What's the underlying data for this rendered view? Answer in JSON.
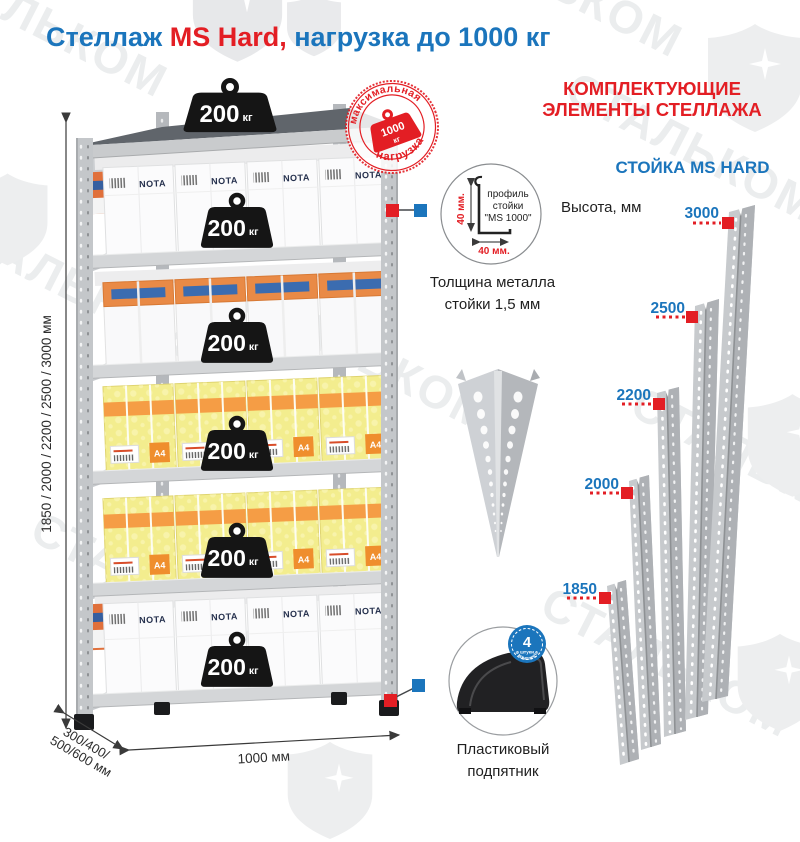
{
  "title": {
    "part1": "Стеллаж ",
    "part2": "MS Hard,",
    "part3": " нагрузка до 1000 кг"
  },
  "watermark": {
    "text": "СТАЛЬКОМ"
  },
  "rack": {
    "weight_value": "200",
    "weight_unit": "кг",
    "box_brand": "NOTA",
    "a4_label": "A4",
    "stamp": {
      "top": "максимальная",
      "bottom": "нагрузка",
      "value": "1000",
      "unit": "кг"
    },
    "dimensions": {
      "height": "1850 / 2000 / 2200 / 2500 / 3000 мм",
      "depth_line1": "300/400/",
      "depth_line2": "500/600 мм",
      "width": "1000 мм"
    }
  },
  "middle": {
    "profile": {
      "line1": "профиль",
      "line2": "стойки",
      "line3": "\"MS 1000\"",
      "dim_vertical": "40 мм.",
      "dim_horizontal": "40 мм."
    },
    "thickness_line1": "Толщина металла",
    "thickness_line2": "стойки 1,5 мм",
    "foot_badge": {
      "count": "4",
      "label_small": "штуки",
      "label_curved": "в комплекте"
    },
    "foot_line1": "Пластиковый",
    "foot_line2": "подпятник"
  },
  "components": {
    "header_line1": "КОМПЛЕКТУЮЩИЕ",
    "header_line2": "ЭЛЕМЕНТЫ СТЕЛЛАЖА",
    "stand_title": "СТОЙКА MS HARD",
    "height_label": "Высота, мм",
    "heights": [
      "3000",
      "2500",
      "2200",
      "2000",
      "1850"
    ]
  },
  "colors": {
    "blue": "#1b75bc",
    "red": "#e31e24",
    "steel": "#c4c7ca",
    "yellow_box": "#f3ed8e",
    "orange": "#ef8e2d",
    "watermark": "#ebedee"
  }
}
